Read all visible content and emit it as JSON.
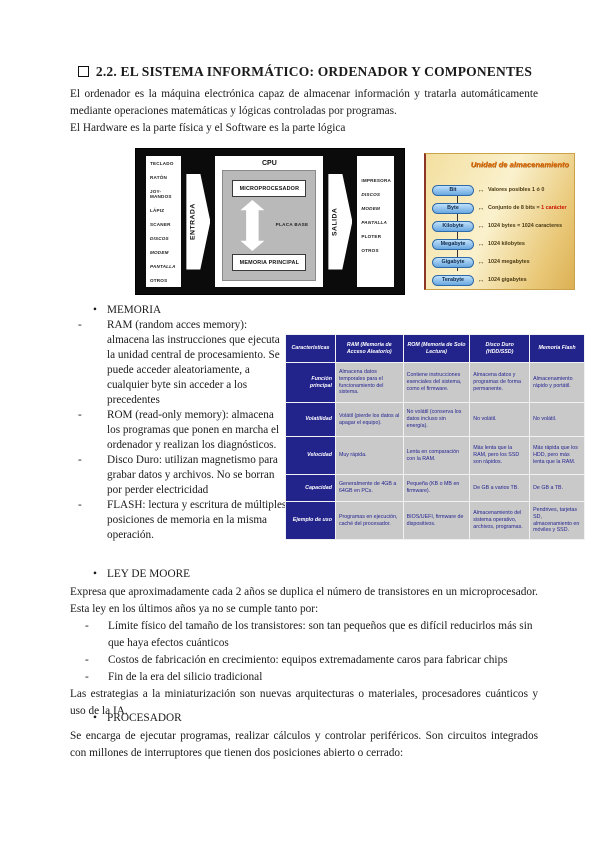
{
  "doc": {
    "title": "2.2. EL SISTEMA INFORMÁTICO: ORDENADOR Y COMPONENTES",
    "intro_para": "El ordenador es la máquina electrónica capaz de almacenar información y tratarla automáticamente mediante operaciones matemáticas y lógicas controladas por programas.",
    "intro_line2": "El Hardware es la parte física y el Software es la parte lógica"
  },
  "hw_diagram": {
    "input_devices": [
      "TECLADO",
      "RATÓN",
      "JOY-MANDOS",
      "LÁPIZ",
      "SCANER",
      "DISCOS",
      "MODEM",
      "PANTALLA",
      "OTROS"
    ],
    "output_devices": [
      "IMPRESORA",
      "DISCOS",
      "MODEM",
      "PANTALLA",
      "PLOTER",
      "OTROS"
    ],
    "emphasized": [
      "DISCOS",
      "MODEM",
      "PANTALLA"
    ],
    "input_arrow_label": "ENTRADA",
    "output_arrow_label": "SALIDA",
    "cpu_label": "CPU",
    "microprocessor_label": "MICROPROCESADOR",
    "board_label": "PLACA BASE",
    "main_memory_label": "MEMORIA  PRINCIPAL"
  },
  "storage_units": {
    "title": "Unidad de almacenamiento",
    "arrow_glyph": "↔",
    "rows": [
      {
        "unit": "Bit",
        "desc": "Valores posibles 1 ó 0",
        "highlight": ""
      },
      {
        "unit": "Byte",
        "desc": "Conjunto de 8 bits = ",
        "highlight": "1 carácter"
      },
      {
        "unit": "Kilobyte",
        "desc": "1024 bytes = 1024 caracteres",
        "highlight": ""
      },
      {
        "unit": "Megabyte",
        "desc": "1024 kilobytes",
        "highlight": ""
      },
      {
        "unit": "Gigabyte",
        "desc": "1024 megabytes",
        "highlight": ""
      },
      {
        "unit": "Terabyte",
        "desc": "1024 gigabytes",
        "highlight": ""
      }
    ]
  },
  "memoria": {
    "marker_bullet": "•",
    "marker_dash": "-",
    "heading": "MEMORIA",
    "items": [
      "RAM (random acces memory): almacena las instrucciones que ejecuta la unidad central de procesamiento. Se puede acceder aleatoriamente, a cualquier byte sin acceder a los  precedentes",
      "ROM (read-only memory): almacena los programas que ponen en marcha el ordenador y realizan los diagnósticos.",
      "Disco Duro: utilizan magnetismo para grabar datos y archivos. No se borran por perder electricidad",
      "FLASH: lectura y escritura de múltiples posiciones de memoria en la misma operación."
    ]
  },
  "memory_table": {
    "col_headers": [
      "Características",
      "RAM (Memoria de Acceso Aleatorio)",
      "ROM (Memoria de Solo Lectura)",
      "Disco Duro (HDD/SSD)",
      "Memoria Flash"
    ],
    "rows": [
      {
        "label": "Función principal",
        "cells": [
          "Almacena datos temporales para el funcionamiento del sistema.",
          "Contiene instrucciones esenciales del sistema, como el firmware.",
          "Almacena datos y programas de forma permanente.",
          "Almacenamiento rápido y portátil."
        ]
      },
      {
        "label": "Volatilidad",
        "cells": [
          "Volátil (pierde los datos al apagar el equipo).",
          "No volátil (conserva los datos incluso sin energía).",
          "No volátil.",
          "No volátil."
        ]
      },
      {
        "label": "Velocidad",
        "cells": [
          "Muy rápida.",
          "Lenta en comparación con la RAM.",
          "Más lenta que la RAM, pero los SSD son rápidos.",
          "Más rápida que los HDD, pero más lenta que la RAM."
        ]
      },
      {
        "label": "Capacidad",
        "cells": [
          "Generalmente de 4GB a 64GB en PCs.",
          "Pequeña (KB o MB en firmware).",
          "De GB a varios TB.",
          "De GB a TB."
        ]
      },
      {
        "label": "Ejemplo de uso",
        "cells": [
          "Programas en ejecución, caché del procesador.",
          "BIOS/UEFI, firmware de dispositivos.",
          "Almacenamiento del sistema operativo, archivos, programas.",
          "Pendrives, tarjetas SD, almacenamiento en móviles y SSD."
        ]
      }
    ]
  },
  "moore": {
    "heading": "LEY DE MOORE",
    "para1": "Expresa que aproximadamente cada 2 años se duplica el número de transistores en un microprocesador. Esta ley en los últimos años ya no se cumple tanto por:",
    "items": [
      "Límite físico del tamaño de los transistores: son tan pequeños que es difícil reducirlos más sin que haya efectos cuánticos",
      "Costos de fabricación en crecimiento: equipos extremadamente caros para fabricar chips",
      "Fin de la era del silicio tradicional"
    ],
    "para2": "Las estrategias a la miniaturización son nuevas arquitecturas o materiales, procesadores cuánticos y uso de la IA."
  },
  "procesador": {
    "heading": "PROCESADOR",
    "para1": "Se encarga de ejecutar programas, realizar cálculos y controlar periféricos. Son circuitos integrados con millones de interruptores que tienen dos posiciones abierto o cerrado:"
  },
  "colors": {
    "table_header_navy": "#23238c",
    "table_cell_gray": "#c9c9c9",
    "table_cell_text": "#1f1f8f",
    "storage_panel_gold": "#eed292",
    "storage_title_orange": "#e0720f",
    "storage_pill_blue": "#8fc3ee",
    "highlight_red": "#cc1100",
    "diagram_bg_black": "#0b0b0b"
  }
}
